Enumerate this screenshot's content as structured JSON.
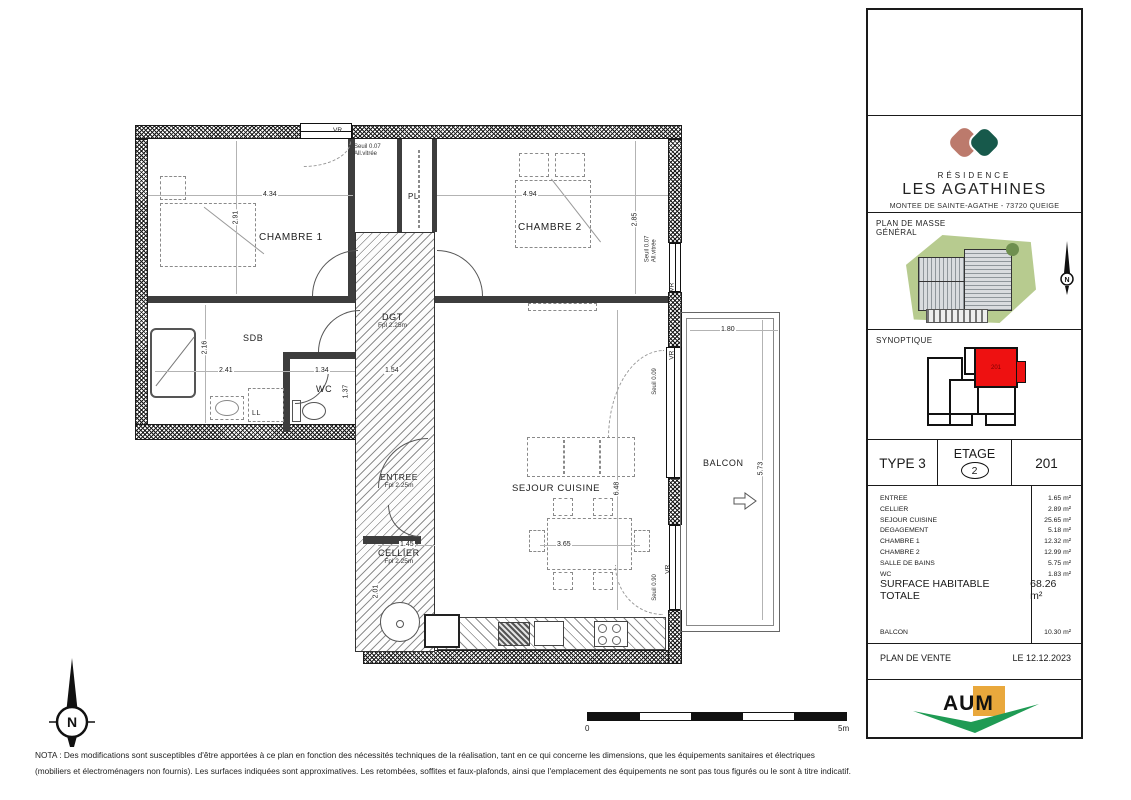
{
  "sidebar": {
    "brand": {
      "top": "RÉSIDENCE",
      "name": "LES AGATHINES",
      "address": "MONTEE DE SAINTE-AGATHE - 73720 QUEIGE"
    },
    "masse": {
      "label1": "PLAN DE MASSE",
      "label2": "GÉNÉRAL"
    },
    "synoptique": {
      "label": "SYNOPTIQUE",
      "unit": "201"
    },
    "unit": {
      "type": "TYPE 3",
      "etage_label": "ETAGE",
      "etage_value": "2",
      "number": "201"
    },
    "areas": {
      "rows": [
        {
          "label": "ENTREE",
          "value": "1.65 m²"
        },
        {
          "label": "CELLIER",
          "value": "2.89 m²"
        },
        {
          "label": "SEJOUR CUISINE",
          "value": "25.65 m²"
        },
        {
          "label": "DEGAGEMENT",
          "value": "5.18 m²"
        },
        {
          "label": "CHAMBRE 1",
          "value": "12.32 m²"
        },
        {
          "label": "CHAMBRE 2",
          "value": "12.99 m²"
        },
        {
          "label": "SALLE DE BAINS",
          "value": "5.75 m²"
        },
        {
          "label": "WC",
          "value": "1.83 m²"
        }
      ],
      "total_label": "SURFACE HABITABLE TOTALE",
      "total_value": "68.26 m²",
      "balcon_label": "BALCON",
      "balcon_value": "10.30 m²"
    },
    "footer": {
      "doc": "PLAN DE VENTE",
      "date": "LE 12.12.2023",
      "agency": "AUM"
    },
    "colors": {
      "unit_highlight": "#ee1111",
      "logo_salmon": "#bc7a6c",
      "logo_green": "#17594b",
      "aum_orange": "#e9a83c",
      "aum_green": "#1f9b54"
    }
  },
  "plan": {
    "vr": "VR",
    "rooms": {
      "chambre1": "CHAMBRE 1",
      "chambre2": "CHAMBRE 2",
      "sdb": "SDB",
      "wc": "WC",
      "dgt": "DGT",
      "dgt_sub": "Fpl 2.25m",
      "entree": "ENTREE",
      "entree_sub": "Fpl 2.25m",
      "cellier": "CELLIER",
      "cellier_sub": "Fpl 2.25m",
      "sejour": "SEJOUR CUISINE",
      "balcon": "BALCON",
      "pl": "PL",
      "ll": "LL"
    },
    "dims": {
      "ch1_w": "4.34",
      "ch1_h": "2.91",
      "ch2_w": "4.94",
      "ch2_h": "2.85",
      "sdb_h": "2.16",
      "sdb_w": "2.41",
      "wc_w": "1.34",
      "wc_h": "1.37",
      "dgt_w": "1.54",
      "cellier_w": "1.45",
      "cellier_h": "2.01",
      "table_w": "3.65",
      "sejour_h": "6.48",
      "balcon_w": "1.80",
      "balcon_h": "5.73"
    },
    "notes": {
      "seuil007": "Seuil 0.07",
      "allvitree": "All.vitrée",
      "seuil009": "Seuil 0.09",
      "seuil090": "Seuil 0.90"
    },
    "scale": {
      "start": "0",
      "end": "5m"
    },
    "compass": "N"
  },
  "nota": {
    "line1": "NOTA : Des modifications sont susceptibles d'être apportées à ce plan en fonction des nécessités techniques de la réalisation, tant en ce qui concerne les dimensions, que les équipements sanitaires et électriques",
    "line2": "(mobiliers et électroménagers non fournis). Les surfaces indiquées sont approximatives. Les retombées, soffites et faux-plafonds, ainsi que l'emplacement des équipements ne sont pas tous figurés ou le sont à titre indicatif."
  }
}
